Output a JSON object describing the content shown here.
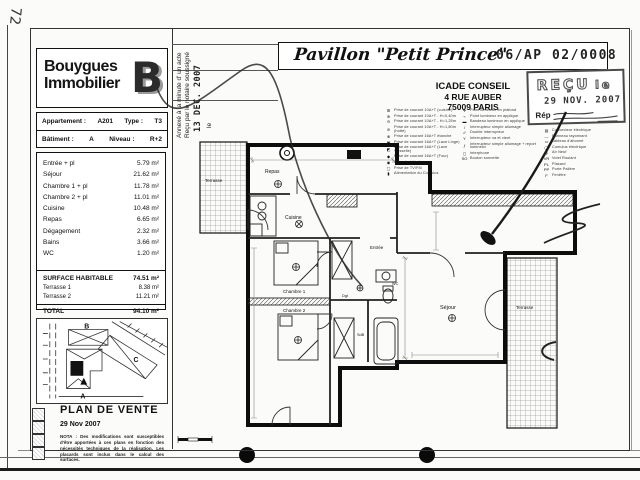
{
  "page": {
    "handwritten_number": "72"
  },
  "logo": {
    "line1": "Bouygues",
    "line2": "Immobilier",
    "mark": "B"
  },
  "apartment_info": {
    "appartement_label": "Appartement :",
    "appartement": "A201",
    "type_label": "Type :",
    "type": "T3",
    "batiment_label": "Bâtiment :",
    "batiment": "A",
    "niveau_label": "Niveau :",
    "niveau": "R+2"
  },
  "areas": {
    "rows": [
      {
        "label": "Entrée + pl",
        "value": "5.79 m²"
      },
      {
        "label": "Séjour",
        "value": "21.62 m²"
      },
      {
        "label": "Chambre 1 + pl",
        "value": "11.78 m²"
      },
      {
        "label": "Chambre 2 + pl",
        "value": "11.01 m²"
      },
      {
        "label": "Cuisine",
        "value": "10.48 m²"
      },
      {
        "label": "Repas",
        "value": "6.65 m²"
      },
      {
        "label": "Dégagement",
        "value": "2.32 m²"
      },
      {
        "label": "Bains",
        "value": "3.66 m²"
      },
      {
        "label": "WC",
        "value": "1.20 m²"
      }
    ],
    "surface_habitable_label": "SURFACE HABITABLE",
    "surface_habitable": "74.51 m²",
    "terrasse1_label": "Terrasse 1",
    "terrasse1": "8.38 m²",
    "terrasse2_label": "Terrasse 2",
    "terrasse2": "11.21 m²",
    "total_label": "TOTAL",
    "total": "94.10 m²"
  },
  "title": {
    "name": "Pavillon \"Petit Prince\"",
    "ref": "06/AP 02/0008"
  },
  "icade": {
    "line1": "ICADE CONSEIL",
    "line2": "4 RUE AUBER",
    "line3": "75009 PARIS"
  },
  "stamp": {
    "recu": "REÇU",
    "le": "le",
    "date": "29 NOV. 2007",
    "rep": "Rép"
  },
  "notary": {
    "line1": "Annexé à la minute d' un acte",
    "line2": "Reçu par le notaire soussigné",
    "le": "le",
    "date": "13 DEC. 2007"
  },
  "legend": {
    "col1": [
      {
        "icon": "⊞",
        "text": "Prise de courant 10A+T (cuisine)"
      },
      {
        "icon": "⊕",
        "text": "Prise de courant 10A+T - H=0,40m"
      },
      {
        "icon": "⊖",
        "text": "Prise de courant 10A+T - H=1,25m"
      },
      {
        "icon": "⊘",
        "text": "Prise de courant 10A+T - H=1,80m (hotte)"
      },
      {
        "icon": "⊗",
        "text": "Prise de courant 16A+T étanche"
      },
      {
        "icon": "▣",
        "text": "Prise de courant 16A+T (Lave Linge)"
      },
      {
        "icon": "◩",
        "text": "Prise de courant 16A+T (Lave Vaisselle)"
      },
      {
        "icon": "◆",
        "text": "Prise de courant 16A+T (Four)"
      },
      {
        "icon": "◉",
        "text": "Prise de téléphone"
      },
      {
        "icon": "▢",
        "text": "Prise de TV/FM"
      },
      {
        "icon": "▮",
        "text": "Alimentation du Cumulus"
      }
    ],
    "col2": [
      {
        "icon": "✛",
        "text": "Point lumineux en plafond"
      },
      {
        "icon": "⌁",
        "text": "Point lumineux en applique"
      },
      {
        "icon": "▬",
        "text": "Bandeau lumineux en applique"
      },
      {
        "icon": "/",
        "text": "Interrupteur simple allumage"
      },
      {
        "icon": "//",
        "text": "Double interrupteur"
      },
      {
        "icon": "Y",
        "text": "Interrupteur va et vient"
      },
      {
        "icon": "ƒ",
        "text": "Interrupteur simple allumage + report lumineux"
      },
      {
        "icon": "◻",
        "text": "Interphone"
      },
      {
        "icon": "SO",
        "text": "Bouton sonnette"
      }
    ],
    "col3": [
      {
        "icon": "▤",
        "text": "Convecteur électrique"
      },
      {
        "icon": "—",
        "text": "Panneau rayonnant"
      },
      {
        "icon": "▭",
        "text": "Tableau d'abonné"
      },
      {
        "icon": "◯",
        "text": "Cumulus électrique"
      },
      {
        "icon": "ϕ",
        "text": "Air Neuf"
      },
      {
        "icon": "VR",
        "text": "Volet Roulant"
      },
      {
        "icon": "PL",
        "text": "Placard"
      },
      {
        "icon": "PP",
        "text": "Porte Palière"
      },
      {
        "icon": "F",
        "text": "Fenêtre"
      }
    ]
  },
  "site_plan": {
    "building_b": "B",
    "building_c": "C",
    "building_a": "A"
  },
  "footer": {
    "title": "PLAN DE VENTE",
    "date": "29 Nov 2007",
    "nota": "NOTA : Des modifications sont susceptibles d'être apportées à ces plans en fonction des nécessités techniques de la réalisation. Les placards sont inclus dans le calcul des surfaces."
  },
  "floor_plan": {
    "labels": {
      "terrasse1": "Terrasse",
      "repas": "Repas",
      "cuisine": "Cuisine",
      "chambre1": "Chambre 1",
      "chambre2": "Chambre 2",
      "entree": "Entrée",
      "sejour": "Séjour",
      "terrasse2": "Terrasse",
      "wc": "WC",
      "sdb": "SdB",
      "dgt": "Dgt"
    }
  }
}
